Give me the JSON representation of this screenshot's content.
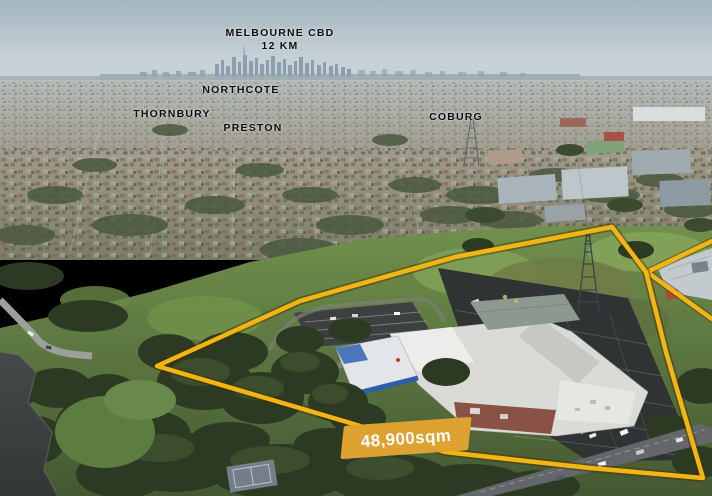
{
  "labels": {
    "cbd_line1": "MELBOURNE CBD",
    "cbd_line2": "12 KM",
    "suburbs": [
      {
        "name": "NORTHCOTE"
      },
      {
        "name": "THORNBURY"
      },
      {
        "name": "PRESTON"
      },
      {
        "name": "COBURG"
      }
    ],
    "area": "48,900sqm"
  },
  "colors": {
    "boundary": "#F1B514",
    "boundary_shadow": "rgba(70,45,0,0.45)",
    "area_box": "#DEA231",
    "area_text": "#FFFFFF",
    "suburb_label_text": "#0C0C0C"
  },
  "scene": {
    "description": "Oblique aerial photograph of a 48,900sqm property outlined in yellow, with the Melbourne CBD skyline on the horizon 12 km away and suburb labels for Northcote, Thornbury, Preston and Coburg."
  }
}
